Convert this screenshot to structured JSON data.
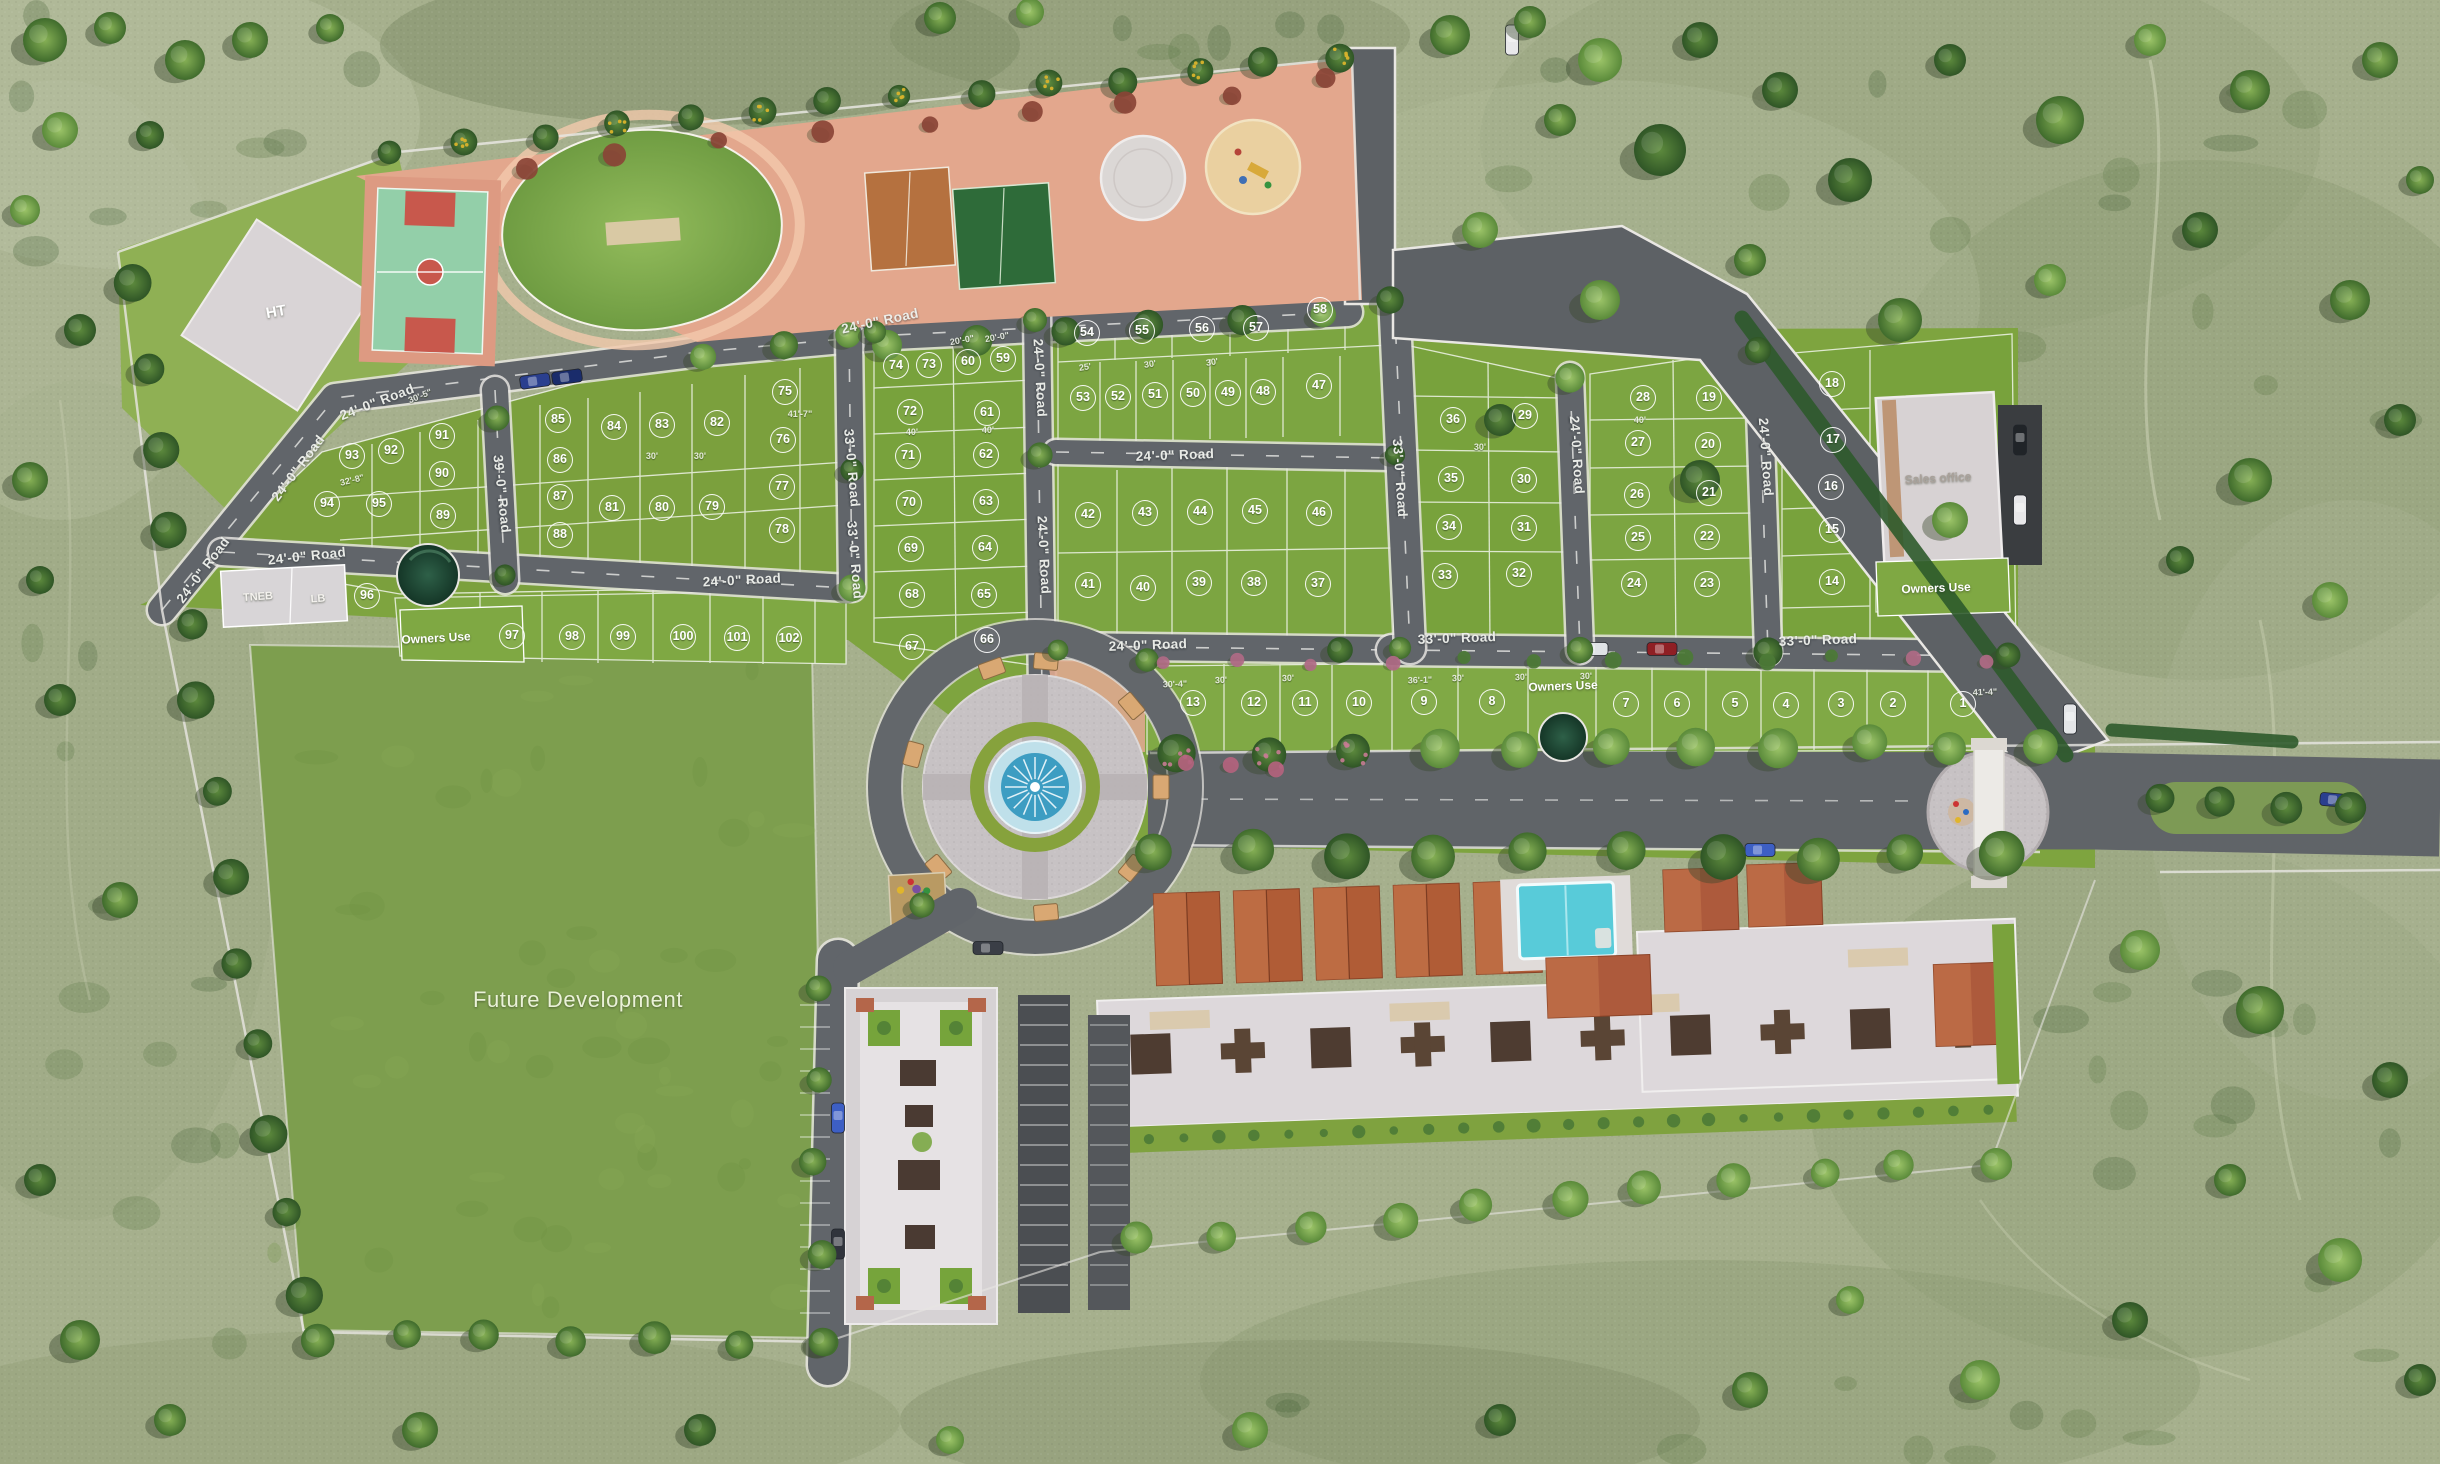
{
  "title": "Residential plotted layout – aerial master plan",
  "colors": {
    "outside_grass": "#a6b08d",
    "plot_green": "#7ba03d",
    "road_gray": "#61656a",
    "curb_white": "#e9e7e3",
    "amenity_pink": "#e3a78d",
    "pool_blue": "#58cbd9",
    "fountain_blue": "#3d9dc2",
    "roof_terracotta": "#b05c36",
    "building_white": "#e3dfe2"
  },
  "area_labels": [
    {
      "id": "future-development",
      "text": "Future Development",
      "x": 578,
      "y": 1000,
      "size": 22,
      "color": "#eaf1d8",
      "rot": 0,
      "thin": true
    },
    {
      "id": "ht",
      "text": "HT",
      "x": 276,
      "y": 312,
      "size": 15,
      "color": "#ffffff",
      "rot": -10,
      "thin": false
    },
    {
      "id": "tneb",
      "text": "TNEB",
      "x": 258,
      "y": 597,
      "size": 11,
      "color": "#f4f2ee",
      "rot": -4,
      "thin": false
    },
    {
      "id": "lb",
      "text": "LB",
      "x": 318,
      "y": 599,
      "size": 11,
      "color": "#f4f2ee",
      "rot": -4,
      "thin": false
    },
    {
      "id": "owners-use-left",
      "text": "Owners Use",
      "x": 436,
      "y": 638,
      "size": 12,
      "color": "#ffffff",
      "rot": -3,
      "thin": false
    },
    {
      "id": "owners-use-bottom",
      "text": "Owners Use",
      "x": 1563,
      "y": 686,
      "size": 12,
      "color": "#ffffff",
      "rot": -2,
      "thin": false
    },
    {
      "id": "owners-use-right",
      "text": "Owners Use",
      "x": 1936,
      "y": 588,
      "size": 12,
      "color": "#ffffff",
      "rot": -2,
      "thin": false
    },
    {
      "id": "sales-office",
      "text": "Sales office",
      "x": 1938,
      "y": 478,
      "size": 12,
      "color": "#a9a19a",
      "rot": -3,
      "thin": false
    }
  ],
  "road_labels": [
    {
      "text": "24'-0\" Road",
      "x": 377,
      "y": 402,
      "rot": -21
    },
    {
      "text": "24'-0\" Road",
      "x": 298,
      "y": 468,
      "rot": -53
    },
    {
      "text": "24'-0\" Road",
      "x": 203,
      "y": 570,
      "rot": -53
    },
    {
      "text": "24'-0\" Road",
      "x": 307,
      "y": 556,
      "rot": -6
    },
    {
      "text": "39'-0\" Road",
      "x": 502,
      "y": 494,
      "rot": 84
    },
    {
      "text": "24'-0\" Road",
      "x": 742,
      "y": 580,
      "rot": -3
    },
    {
      "text": "24'-0\" Road",
      "x": 880,
      "y": 321,
      "rot": -12
    },
    {
      "text": "33'-0\" Road",
      "x": 852,
      "y": 468,
      "rot": 85
    },
    {
      "text": "33'-0\" Road",
      "x": 855,
      "y": 560,
      "rot": 85
    },
    {
      "text": "24'-0\" Road",
      "x": 1040,
      "y": 378,
      "rot": 87
    },
    {
      "text": "24'-0\" Road",
      "x": 1044,
      "y": 555,
      "rot": 87
    },
    {
      "text": "24'-0\" Road",
      "x": 1175,
      "y": 455,
      "rot": -2
    },
    {
      "text": "24'-0\" Road",
      "x": 1148,
      "y": 645,
      "rot": -2
    },
    {
      "text": "33'-0\" Road",
      "x": 1400,
      "y": 478,
      "rot": 86
    },
    {
      "text": "24'-0\" Road",
      "x": 1577,
      "y": 455,
      "rot": 86
    },
    {
      "text": "24'-0\" Road",
      "x": 1766,
      "y": 457,
      "rot": 86
    },
    {
      "text": "33'-0\" Road",
      "x": 1457,
      "y": 638,
      "rot": -2
    },
    {
      "text": "33'-0\" Road",
      "x": 1818,
      "y": 640,
      "rot": -2
    }
  ],
  "dimension_labels": [
    {
      "text": "30'-5\"",
      "x": 420,
      "y": 396,
      "rot": -22
    },
    {
      "text": "32'-8\"",
      "x": 352,
      "y": 480,
      "rot": -14
    },
    {
      "text": "41'-7\"",
      "x": 800,
      "y": 414,
      "rot": 0
    },
    {
      "text": "30'",
      "x": 652,
      "y": 456,
      "rot": 0
    },
    {
      "text": "30'",
      "x": 700,
      "y": 456,
      "rot": 0
    },
    {
      "text": "20'-0\"",
      "x": 962,
      "y": 340,
      "rot": -10
    },
    {
      "text": "20'-0\"",
      "x": 997,
      "y": 337,
      "rot": -10
    },
    {
      "text": "25'",
      "x": 1085,
      "y": 367,
      "rot": -8
    },
    {
      "text": "30'",
      "x": 1150,
      "y": 364,
      "rot": -8
    },
    {
      "text": "30'",
      "x": 1212,
      "y": 362,
      "rot": -8
    },
    {
      "text": "40'",
      "x": 912,
      "y": 432,
      "rot": 0
    },
    {
      "text": "40'",
      "x": 988,
      "y": 430,
      "rot": 0
    },
    {
      "text": "30'-4\"",
      "x": 1175,
      "y": 684,
      "rot": -2
    },
    {
      "text": "30'",
      "x": 1221,
      "y": 680,
      "rot": -2
    },
    {
      "text": "30'",
      "x": 1288,
      "y": 678,
      "rot": -2
    },
    {
      "text": "36'-1\"",
      "x": 1420,
      "y": 680,
      "rot": -2
    },
    {
      "text": "30'",
      "x": 1458,
      "y": 678,
      "rot": -2
    },
    {
      "text": "30'",
      "x": 1521,
      "y": 677,
      "rot": -2
    },
    {
      "text": "30'",
      "x": 1586,
      "y": 676,
      "rot": -2
    },
    {
      "text": "41'-4\"",
      "x": 1985,
      "y": 692,
      "rot": -2
    },
    {
      "text": "40'",
      "x": 1640,
      "y": 420,
      "rot": 0
    },
    {
      "text": "30'",
      "x": 1480,
      "y": 447,
      "rot": 0
    }
  ],
  "plots": [
    [
      1,
      1963,
      704
    ],
    [
      2,
      1893,
      704
    ],
    [
      3,
      1841,
      704
    ],
    [
      4,
      1786,
      705
    ],
    [
      5,
      1735,
      704
    ],
    [
      6,
      1677,
      704
    ],
    [
      7,
      1626,
      704
    ],
    [
      8,
      1492,
      702
    ],
    [
      9,
      1424,
      702
    ],
    [
      10,
      1359,
      703
    ],
    [
      11,
      1305,
      703
    ],
    [
      12,
      1254,
      703
    ],
    [
      13,
      1193,
      703
    ],
    [
      14,
      1832,
      582
    ],
    [
      15,
      1832,
      530
    ],
    [
      16,
      1831,
      487
    ],
    [
      17,
      1833,
      440
    ],
    [
      18,
      1832,
      384
    ],
    [
      19,
      1709,
      398
    ],
    [
      20,
      1708,
      445
    ],
    [
      21,
      1709,
      493
    ],
    [
      22,
      1707,
      537
    ],
    [
      23,
      1707,
      584
    ],
    [
      24,
      1634,
      584
    ],
    [
      25,
      1638,
      538
    ],
    [
      26,
      1637,
      495
    ],
    [
      27,
      1638,
      443
    ],
    [
      28,
      1643,
      398
    ],
    [
      29,
      1525,
      416
    ],
    [
      30,
      1524,
      480
    ],
    [
      31,
      1524,
      528
    ],
    [
      32,
      1519,
      574
    ],
    [
      33,
      1445,
      576
    ],
    [
      34,
      1449,
      527
    ],
    [
      35,
      1451,
      479
    ],
    [
      36,
      1453,
      420
    ],
    [
      37,
      1318,
      584
    ],
    [
      38,
      1254,
      583
    ],
    [
      39,
      1199,
      583
    ],
    [
      40,
      1143,
      588
    ],
    [
      41,
      1088,
      585
    ],
    [
      42,
      1088,
      515
    ],
    [
      43,
      1145,
      513
    ],
    [
      44,
      1200,
      512
    ],
    [
      45,
      1255,
      511
    ],
    [
      46,
      1319,
      513
    ],
    [
      47,
      1319,
      386
    ],
    [
      48,
      1263,
      392
    ],
    [
      49,
      1228,
      393
    ],
    [
      50,
      1193,
      394
    ],
    [
      51,
      1155,
      395
    ],
    [
      52,
      1118,
      397
    ],
    [
      53,
      1083,
      398
    ],
    [
      54,
      1087,
      333
    ],
    [
      55,
      1142,
      331
    ],
    [
      56,
      1202,
      329
    ],
    [
      57,
      1256,
      328
    ],
    [
      58,
      1320,
      310
    ],
    [
      59,
      1003,
      359
    ],
    [
      60,
      968,
      362
    ],
    [
      61,
      987,
      413
    ],
    [
      62,
      986,
      455
    ],
    [
      63,
      986,
      502
    ],
    [
      64,
      985,
      548
    ],
    [
      65,
      984,
      595
    ],
    [
      66,
      987,
      640
    ],
    [
      67,
      912,
      647
    ],
    [
      68,
      912,
      595
    ],
    [
      69,
      911,
      549
    ],
    [
      70,
      909,
      503
    ],
    [
      71,
      908,
      456
    ],
    [
      72,
      910,
      412
    ],
    [
      73,
      929,
      365
    ],
    [
      74,
      896,
      366
    ],
    [
      75,
      785,
      392
    ],
    [
      76,
      783,
      440
    ],
    [
      77,
      782,
      487
    ],
    [
      78,
      782,
      530
    ],
    [
      79,
      712,
      507
    ],
    [
      80,
      662,
      508
    ],
    [
      81,
      612,
      508
    ],
    [
      82,
      717,
      423
    ],
    [
      83,
      662,
      425
    ],
    [
      84,
      614,
      427
    ],
    [
      85,
      558,
      420
    ],
    [
      86,
      560,
      460
    ],
    [
      87,
      560,
      497
    ],
    [
      88,
      560,
      535
    ],
    [
      89,
      443,
      516
    ],
    [
      90,
      442,
      474
    ],
    [
      91,
      442,
      436
    ],
    [
      92,
      391,
      451
    ],
    [
      93,
      352,
      456
    ],
    [
      94,
      327,
      504
    ],
    [
      95,
      379,
      504
    ],
    [
      96,
      367,
      596
    ],
    [
      97,
      512,
      636
    ],
    [
      98,
      572,
      637
    ],
    [
      99,
      623,
      637
    ],
    [
      100,
      683,
      637
    ],
    [
      101,
      737,
      638
    ],
    [
      102,
      789,
      639
    ]
  ]
}
